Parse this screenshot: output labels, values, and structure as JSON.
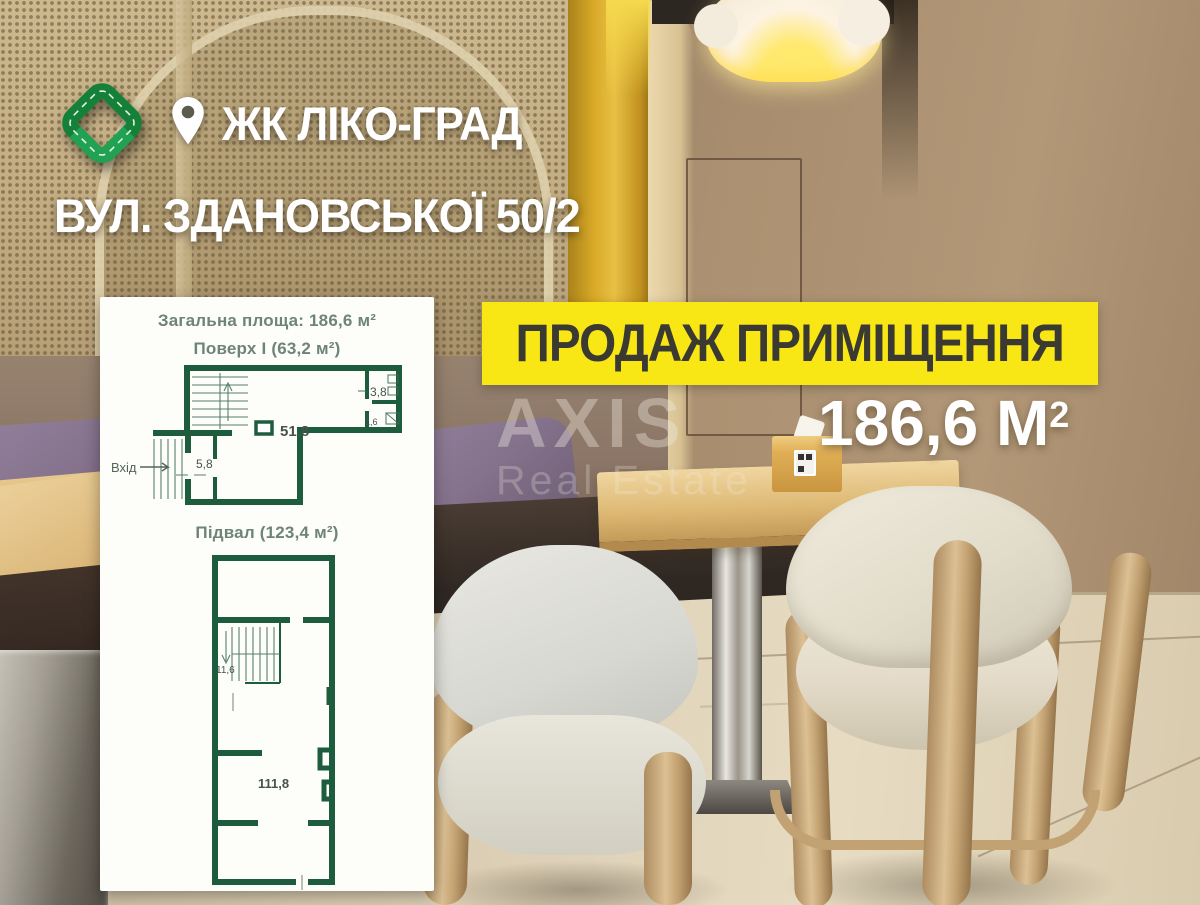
{
  "header": {
    "complex_name": "ЖК ЛІКО-ГРАД",
    "address": "ВУЛ. ЗДАНОВСЬКОЇ 50/2"
  },
  "banner": {
    "label": "ПРОДАЖ ПРИМІЩЕННЯ"
  },
  "area": {
    "value": "186,6 М",
    "superscript": "2"
  },
  "watermark": {
    "line1": "AXIS",
    "line2": "Real Estate"
  },
  "floorplan": {
    "total_area": "Загальна площа: 186,6 м²",
    "floor1": {
      "title": "Поверх І (63,2 м²)",
      "labels": {
        "wc": "3,8",
        "wc_small": "1,6",
        "hall": "51,8",
        "vestibule": "5,8",
        "entrance": "Вхід"
      }
    },
    "basement": {
      "title": "Підвал (123,4 м²)",
      "labels": {
        "stairs": "11,6",
        "hall": "111,8"
      }
    }
  },
  "icons": {
    "logo": "green-knot-logo",
    "location": "map-pin"
  },
  "colors": {
    "accent_yellow": "#f8e714",
    "plan_green": "#1e5c3e",
    "panel_title_green": "#6e837a",
    "banner_text": "#3a3a32",
    "headline_white": "#ffffff",
    "logo_green": "#1c9247"
  }
}
